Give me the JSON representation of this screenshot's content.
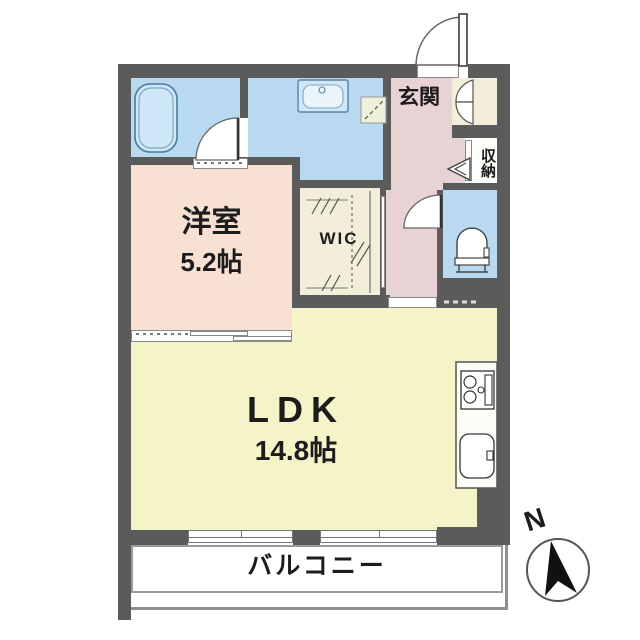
{
  "plan_title": "apartment-floor-plan",
  "colors": {
    "wall": "#5b5b5b",
    "wet-area": "#b9d9f0",
    "fixture-fill": "#cfe7f6",
    "bedroom": "#f8e0d3",
    "ldk": "#f5f4c9",
    "hall": "#e7d2d4",
    "closet": "#f2eeda",
    "line": "#555555"
  },
  "rooms": {
    "bedroom": {
      "name": "洋室",
      "size": "5.2帖"
    },
    "ldk": {
      "name": "LDK",
      "size": "14.8帖"
    },
    "wic": {
      "label": "WIC"
    },
    "genkan": {
      "label": "玄関"
    },
    "storage": {
      "label": "収納"
    },
    "balcony": {
      "label": "バルコニー"
    }
  },
  "compass": {
    "north_label": "N"
  },
  "fixtures": [
    "bathtub",
    "washbasin",
    "toilet",
    "gas-stove",
    "kitchen-sink",
    "entrance-door",
    "bathroom-door",
    "toilet-door",
    "shoe-closet-double-door",
    "storage-folding-door",
    "sliding-doors",
    "windows",
    "compass-north-arrow"
  ]
}
